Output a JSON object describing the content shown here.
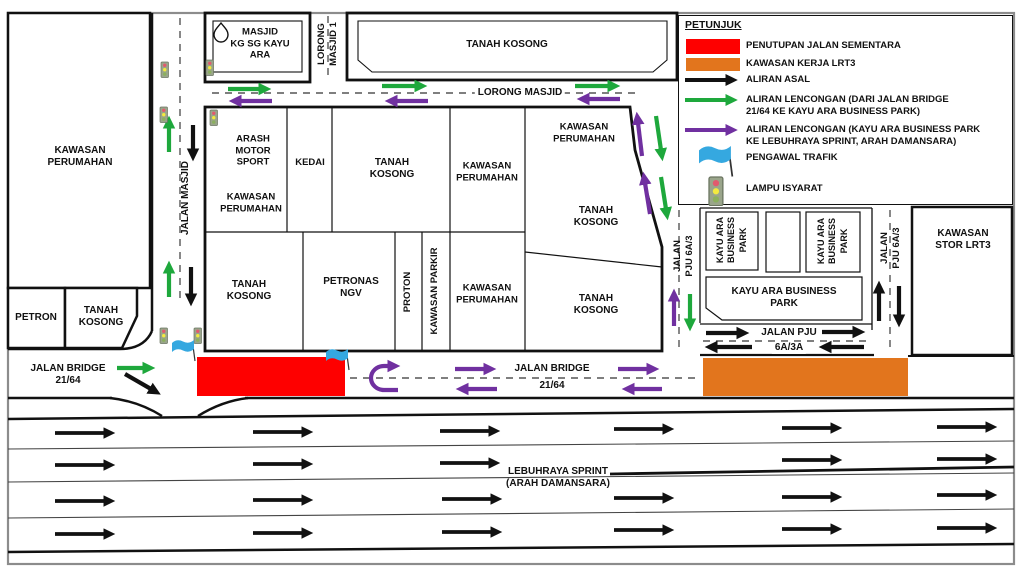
{
  "colors": {
    "closure_red": "#fe0000",
    "work_orange": "#e2751d",
    "diversion_green": "#1ea83c",
    "diversion_purple": "#7030a0",
    "flag_blue": "#35a8e0",
    "line_black": "#111111"
  },
  "legend": {
    "title": "PETUNJUK",
    "items": [
      {
        "key": "closure",
        "swatch": "red-rect",
        "label": "PENUTUPAN JALAN SEMENTARA"
      },
      {
        "key": "work_area",
        "swatch": "orange-rect",
        "label": "KAWASAN KERJA LRT3"
      },
      {
        "key": "original_flow",
        "swatch": "black-arrow",
        "label": "ALIRAN ASAL"
      },
      {
        "key": "diversion_green",
        "swatch": "green-arrow",
        "label": "ALIRAN LENCONGAN (DARI JALAN BRIDGE\n21/64 KE KAYU ARA BUSINESS PARK)"
      },
      {
        "key": "diversion_purple",
        "swatch": "purple-arrow",
        "label": "ALIRAN LENCONGAN (KAYU ARA BUSINESS PARK\nKE LEBUHRAYA SPRINT, ARAH DAMANSARA)"
      },
      {
        "key": "traffic_marshal",
        "swatch": "flag-icon",
        "label": "PENGAWAL TRAFIK"
      },
      {
        "key": "traffic_light",
        "swatch": "traffic-light-icon",
        "label": "LAMPU ISYARAT"
      }
    ]
  },
  "roads": {
    "jalan_masjid": "JALAN MASJID",
    "lorong_masjid_1": "LORONG\nMASJID 1",
    "lorong_masjid": "LORONG MASJID",
    "jalan_pju_6a3_left": "JALAN\nPJU 6A/3",
    "jalan_pju_6a3_right": "JALAN\nPJU 6A/3",
    "jalan_pju_6a3a_line1": "JALAN PJU",
    "jalan_pju_6a3a_line2": "6A/3A",
    "jalan_bridge_west": "JALAN BRIDGE\n21/64",
    "jalan_bridge_line1": "JALAN BRIDGE",
    "jalan_bridge_line2": "21/64",
    "lebuhraya_sprint": "LEBUHRAYA SPRINT\n(ARAH DAMANSARA)"
  },
  "areas": {
    "kawasan_perumahan_nw": "KAWASAN\nPERUMAHAN",
    "petron": "PETRON",
    "tanah_kosong_sw": "TANAH\nKOSONG",
    "masjid": "MASJID\nKG SG KAYU\nARA",
    "tanah_kosong_top": "TANAH KOSONG",
    "arash_motor_sport": "ARASH\nMOTOR\nSPORT",
    "kawasan_perumahan_arash": "KAWASAN\nPERUMAHAN",
    "kedai": "KEDAI",
    "tanah_kosong_c": "TANAH\nKOSONG",
    "kawasan_perumahan_c4a": "KAWASAN\nPERUMAHAN",
    "kawasan_perumahan_ne": "KAWASAN\nPERUMAHAN",
    "tanah_kosong_e1": "TANAH\nKOSONG",
    "tanah_kosong_s": "TANAH\nKOSONG",
    "petronas_ngv": "PETRONAS\nNGV",
    "proton": "PROTON",
    "kawasan_parkir": "KAWASAN PARKIR",
    "kawasan_perumahan_c4b": "KAWASAN\nPERUMAHAN",
    "tanah_kosong_e2": "TANAH\nKOSONG",
    "kayu_ara_bp_v1": "KAYU ARA\nBUSINESS\nPARK",
    "kayu_ara_bp_v2": "KAYU ARA\nBUSINESS\nPARK",
    "kayu_ara_bp_main": "KAYU ARA BUSINESS\nPARK",
    "kawasan_stor_lrt3": "KAWASAN\nSTOR LRT3"
  }
}
